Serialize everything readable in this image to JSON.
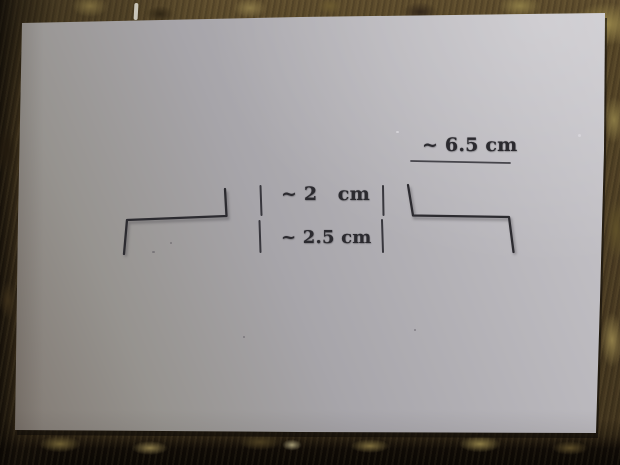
{
  "photo": {
    "alt": "Two Z-bent wire templates lying on a sheet of paper with stamped measurement markings, photographed on a wooden workbench",
    "colors": {
      "workbench_wood": "#4a3b22",
      "workbench_dark_edge": "#0d0905",
      "paper_highlight": "#c9c7cc",
      "paper_shadow_tone": "#7d756d",
      "ink": "#2b2a2f"
    },
    "measurements": {
      "top": "~ 6.5 cm",
      "middle": "~ 2   cm",
      "bottom": "~ 2.5 cm"
    },
    "wires": {
      "left_points": "225,189 226.5,216 127,220 124,254",
      "right_points": "408,185 413,215.5 509,217 513.5,252"
    }
  }
}
